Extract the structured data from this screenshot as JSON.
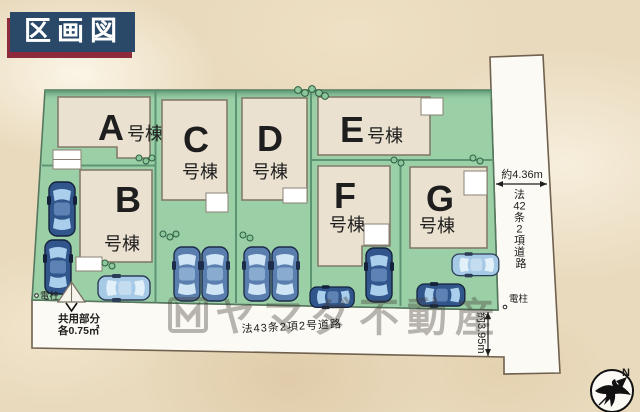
{
  "title": "区画図",
  "buildings": [
    {
      "letter": "A",
      "suffix": "号棟"
    },
    {
      "letter": "B",
      "suffix": "号棟"
    },
    {
      "letter": "C",
      "suffix": "号棟"
    },
    {
      "letter": "D",
      "suffix": "号棟"
    },
    {
      "letter": "E",
      "suffix": "号棟"
    },
    {
      "letter": "F",
      "suffix": "号棟"
    },
    {
      "letter": "G",
      "suffix": "号棟"
    }
  ],
  "roads": {
    "right": {
      "name": "法42条2項道路",
      "chars": [
        "法",
        "42",
        "条",
        "2",
        "項",
        "道",
        "路"
      ],
      "width_label": "約4.36m"
    },
    "bottom": {
      "name": "法43条2項2号道路",
      "depth_label": "約3.95m"
    }
  },
  "annotations": {
    "utility_pole": "電柱",
    "common_area_line1": "共用部分",
    "common_area_line2": "各0.75㎡",
    "north": "N"
  },
  "watermark": {
    "text": "ヤマダ不動産"
  },
  "colors": {
    "plot_green": "#9bcfa6",
    "road_white": "#fcfaf4",
    "building_fill": "#eae1d0",
    "title_bg": "#2a4868",
    "title_shadow": "#8d2a3c",
    "car_navy": "#31568c",
    "car_light": "#a6c9e6"
  }
}
